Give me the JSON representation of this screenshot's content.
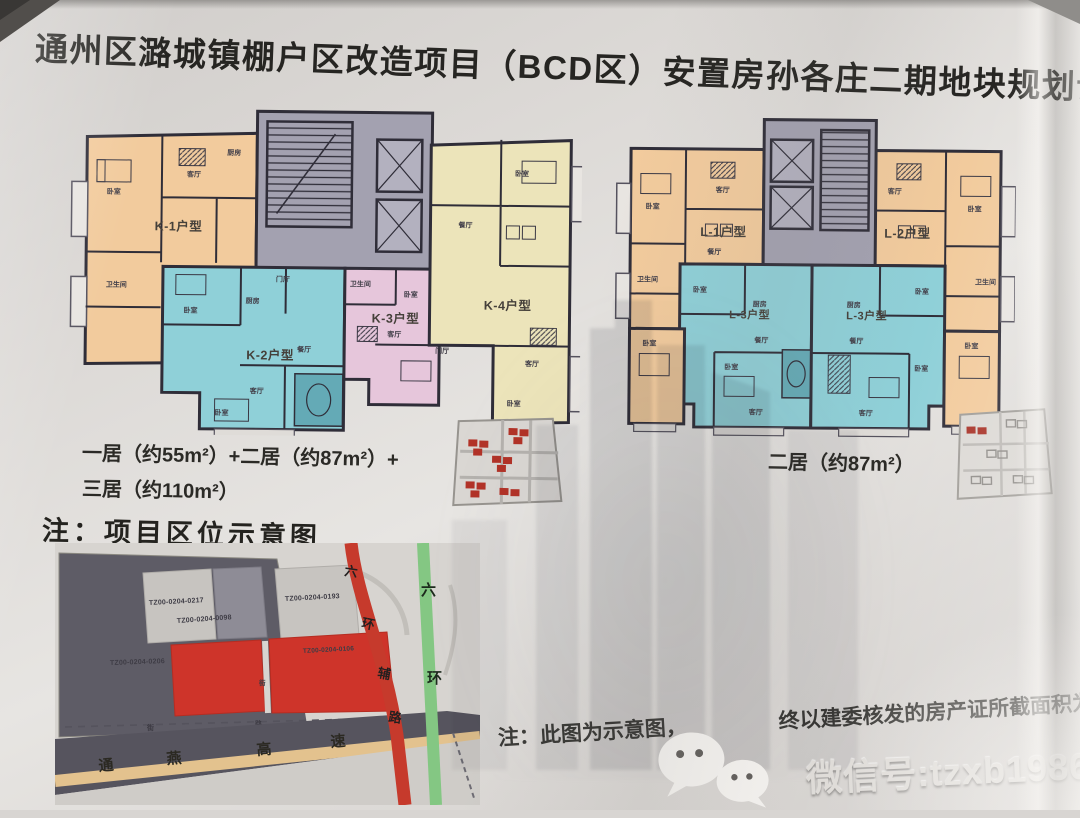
{
  "title": "通州区潞城镇棚户区改造项目（BCD区）安置房孙各庄二期地块规划设计方案",
  "plans": {
    "left": {
      "units": [
        {
          "label": "K-1户型"
        },
        {
          "label": "K-2户型"
        },
        {
          "label": "K-3户型"
        },
        {
          "label": "K-4户型"
        }
      ],
      "caption_line1": "一居（约55m²）+二居（约87m²）+",
      "caption_line2": "三居（约110m²）"
    },
    "right": {
      "units": [
        {
          "label": "L-1户型"
        },
        {
          "label": "L-2户型"
        },
        {
          "label": "L-3户型"
        },
        {
          "label": "L-3户型"
        }
      ],
      "caption": "二居（约87m²）"
    }
  },
  "rooms": {
    "bedroom": "卧室",
    "living": "客厅",
    "dining": "餐厅",
    "kitchen": "厨房",
    "bath": "卫生间",
    "hall": "门厅"
  },
  "map": {
    "heading": "注：项目区位示意图",
    "parcels": {
      "p1": "TZ00-0204-0217",
      "p2": "TZ00-0204-0098",
      "p3": "TZ00-0204-0193",
      "p4": "TZ00-0204-0106",
      "p5": "TZ00-0204-0206"
    },
    "roads": {
      "ring_aux": "六环辅路",
      "ring_aux_chars": [
        "六",
        "环",
        "辅",
        "路"
      ],
      "ring": "六环",
      "ring_chars": [
        "六",
        "环"
      ],
      "highway": "通燕高速",
      "highway_chars": [
        "通",
        "燕",
        "高",
        "速"
      ],
      "street": "街",
      "road": "路"
    }
  },
  "note": {
    "part1": "注：此图为示意图，",
    "part2": "终以建委核发的房产证所截面积为准"
  },
  "watermark": {
    "text": "微信号:tzxb1986"
  },
  "colors": {
    "unit_orange": "#f2cb9d",
    "unit_cyan": "#8fd0d8",
    "unit_pink": "#e6c6db",
    "unit_yellow": "#ece4ba",
    "core_gray": "#a3a1b0",
    "parcel_red": "#ce342a",
    "road_red": "#c63a2c",
    "road_green": "#84c783",
    "highway_tan": "#e3c28e"
  }
}
